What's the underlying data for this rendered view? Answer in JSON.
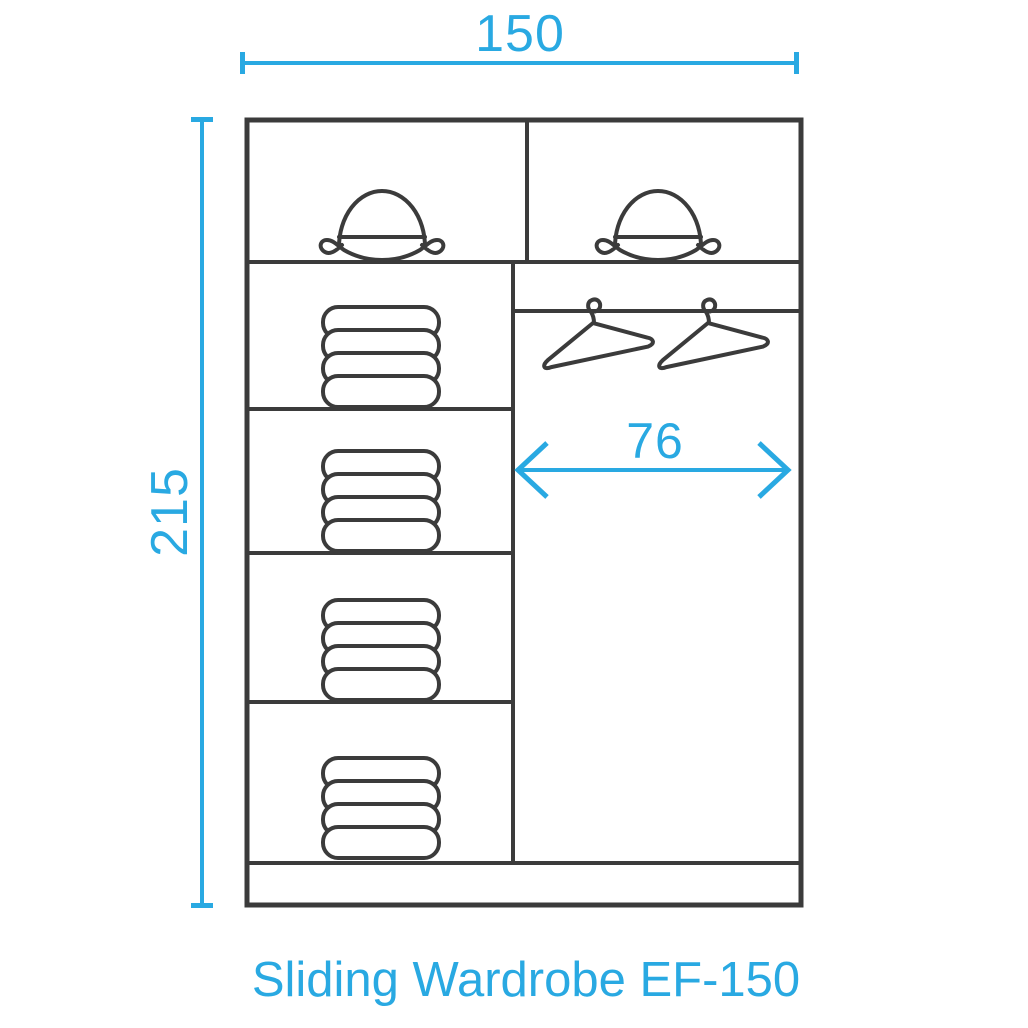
{
  "title": {
    "text": "Sliding Wardrobe EF-150"
  },
  "dimensions": {
    "width": {
      "value": "150",
      "orientation": "horizontal",
      "position": "top"
    },
    "height": {
      "value": "215",
      "orientation": "vertical",
      "position": "left"
    },
    "hanging_width": {
      "value": "76",
      "orientation": "horizontal",
      "position": "inside-right-column"
    }
  },
  "colors": {
    "accent": "#29A9E2",
    "line": "#3B3B3B",
    "background": "#FFFFFF"
  },
  "wardrobe": {
    "top_row": {
      "compartments": [
        {
          "icon": "bowler-hat-icon"
        },
        {
          "icon": "bowler-hat-icon"
        }
      ]
    },
    "left_column": {
      "shelves": [
        {
          "icon": "folded-clothes-icon"
        },
        {
          "icon": "folded-clothes-icon"
        },
        {
          "icon": "folded-clothes-icon"
        },
        {
          "icon": "folded-clothes-icon"
        }
      ]
    },
    "right_column": {
      "rail": "hanging-rail",
      "hangers": [
        {
          "icon": "clothes-hanger-icon"
        },
        {
          "icon": "clothes-hanger-icon"
        }
      ]
    },
    "base": "empty-plinth-strip"
  }
}
